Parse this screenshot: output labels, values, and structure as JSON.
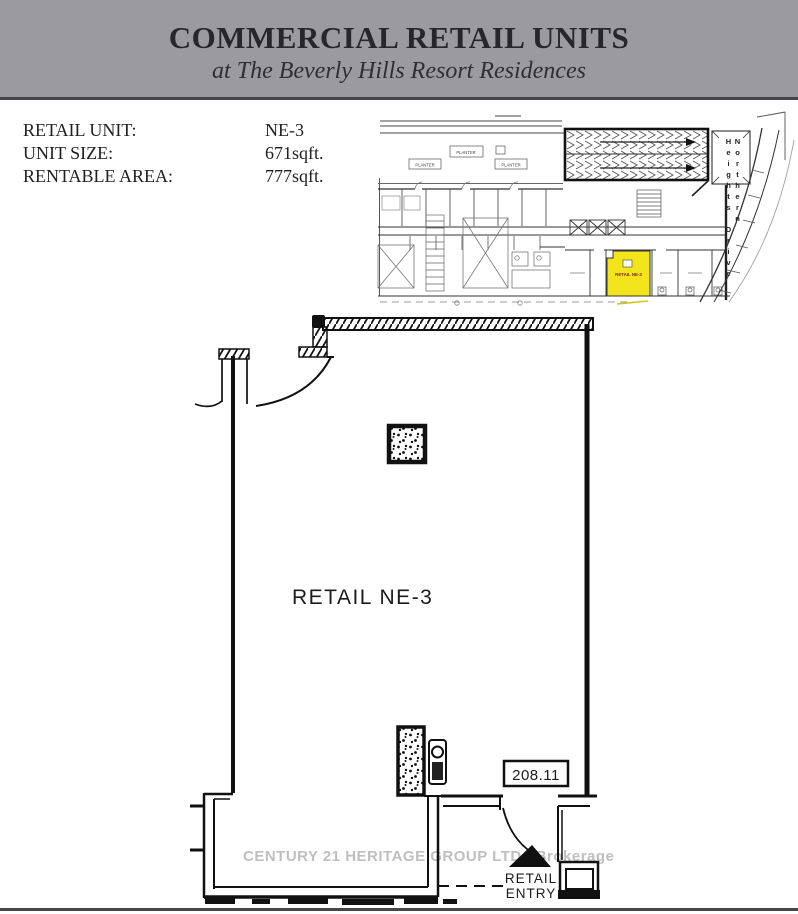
{
  "header": {
    "title": "COMMERCIAL RETAIL UNITS",
    "subtitle": "at The Beverly Hills Resort Residences"
  },
  "unit_info": {
    "rows": [
      {
        "label": "RETAIL UNIT:",
        "value": "NE-3"
      },
      {
        "label": "UNIT SIZE:",
        "value": "671sqft."
      },
      {
        "label": "RENTABLE AREA:",
        "value": "777sqft."
      }
    ]
  },
  "site_plan": {
    "street_name": "Northern Heights Drive",
    "planters": [
      "PLANTER",
      "PLANTER",
      "PLANTER"
    ],
    "unit_label": "RETAIL NE-3"
  },
  "floor_plan": {
    "room_label": "RETAIL NE-3",
    "door_number": "208.11",
    "entry_line1": "RETAIL",
    "entry_line2": "ENTRY"
  },
  "watermark": {
    "text": "CENTURY 21 HERITAGE GROUP LTD., Brokerage"
  },
  "colors": {
    "header_bg": "#9b9b9f",
    "header_rule": "#47474b",
    "highlight_yellow": "#f2e51b",
    "plan_line": "#111111",
    "watermark_gray": "#b4b4b4",
    "unit_label_red": "#7a2720"
  }
}
